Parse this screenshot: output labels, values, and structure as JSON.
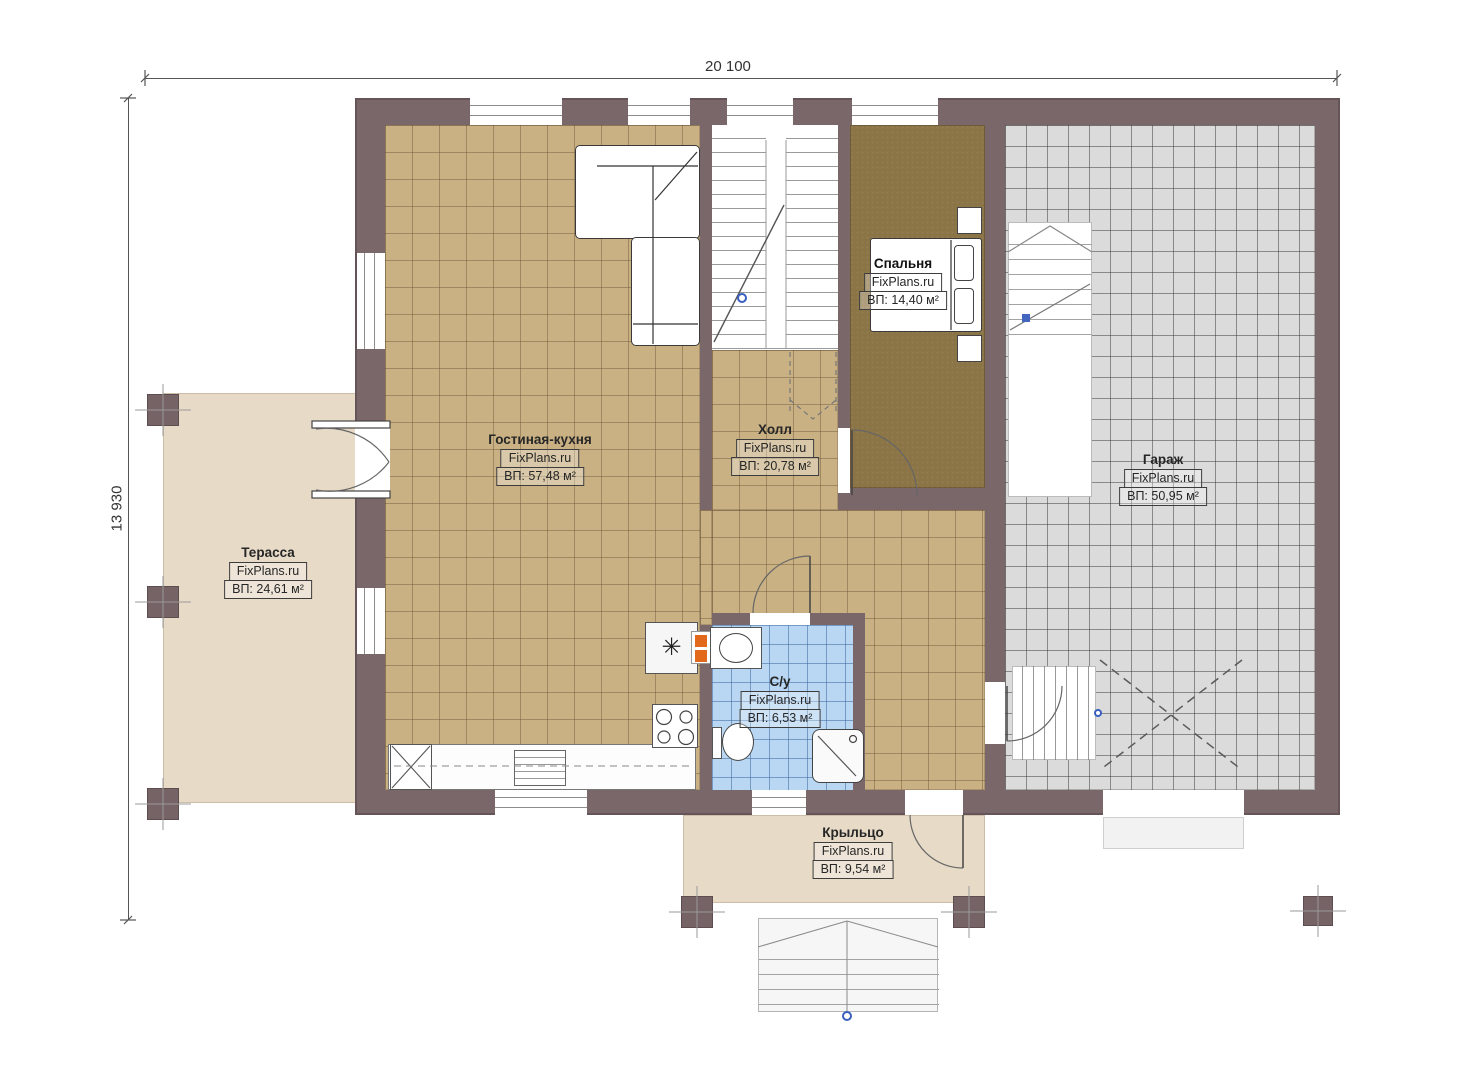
{
  "plan": {
    "dimensions": {
      "width_label": "20 100",
      "height_label": "13 930"
    },
    "rooms": [
      {
        "key": "living",
        "name": "Гостиная-кухня",
        "brand": "FixPlans.ru",
        "area": "ВП: 57,48 м²"
      },
      {
        "key": "hall",
        "name": "Холл",
        "brand": "FixPlans.ru",
        "area": "ВП: 20,78 м²"
      },
      {
        "key": "bedroom",
        "name": "Спальня",
        "brand": "FixPlans.ru",
        "area": "ВП: 14,40 м²"
      },
      {
        "key": "garage",
        "name": "Гараж",
        "brand": "FixPlans.ru",
        "area": "ВП: 50,95 м²"
      },
      {
        "key": "terrace",
        "name": "Терасса",
        "brand": "FixPlans.ru",
        "area": "ВП: 24,61 м²"
      },
      {
        "key": "bathroom",
        "name": "С/у",
        "brand": "FixPlans.ru",
        "area": "ВП: 6,53 м²"
      },
      {
        "key": "porch",
        "name": "Крыльцо",
        "brand": "FixPlans.ru",
        "area": "ВП: 9,54 м²"
      }
    ],
    "symbols": {
      "appliance_star": "✳"
    },
    "colors": {
      "wall": "#7a6769",
      "floor_tile": "#c9b184",
      "carpet": "#8b7446",
      "garage_floor": "#dbdbdb",
      "bath_floor": "#b9d6f2",
      "deck": "#e7dac7",
      "accent_orange": "#e2681c",
      "marker_blue": "#3a5fc0"
    }
  }
}
